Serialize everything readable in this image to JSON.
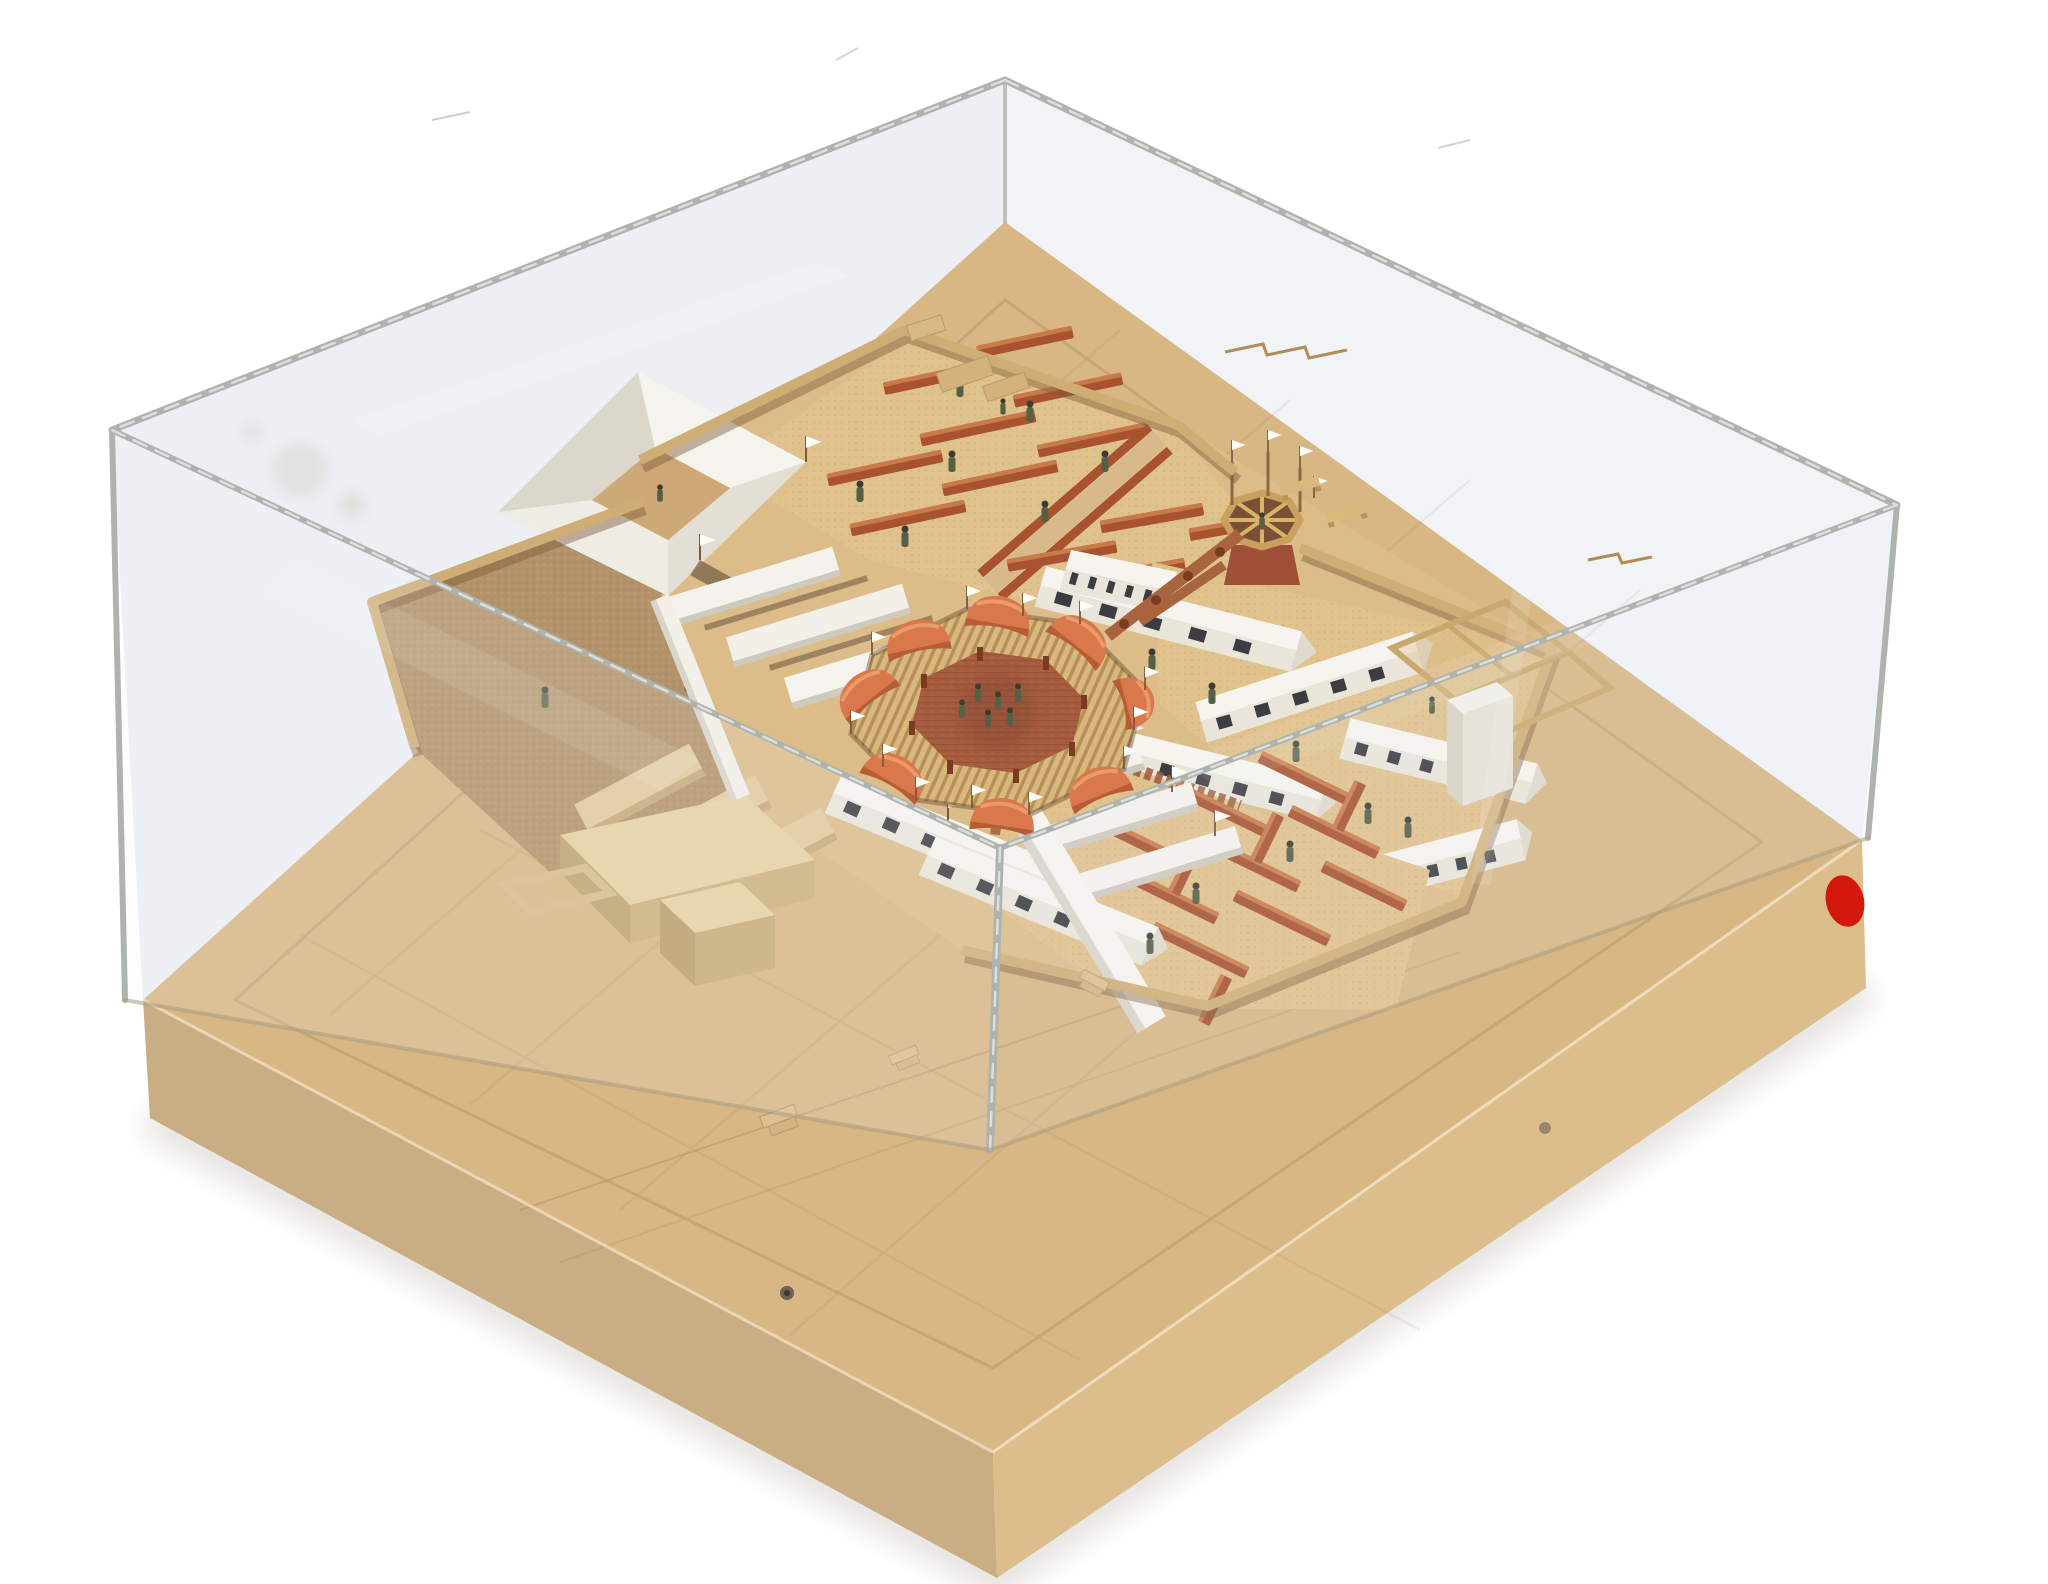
{
  "scene": {
    "type": "photograph",
    "subject": "architectural scale model of an octagonal walled prison-camp complex with radial courtyards, under a clear acrylic display case on a pale wooden base, three-quarter aerial view on white background"
  },
  "palette": {
    "background": "#ffffff",
    "acrylic_edge": "#aeb3af",
    "acrylic_tint": "#e9edf3",
    "wood_top": "#ddbd8a",
    "wood_side_left": "#c9ad83",
    "wood_side_right": "#dcbe8c",
    "terrain": "#dcbd8a",
    "sand": "#b2936a",
    "courtyard_floor": "#e0c28d",
    "brick_plaza": "#a65c3f",
    "pavilion_orange": "#d9784b",
    "pergola_wood": "#d8b87c",
    "roof_white": "#f6f4ee",
    "roof_shade": "#e0dcd0",
    "bench_red": "#a85230",
    "bench_highlight": "#c97a4a",
    "wall_wood": "#cfae76",
    "wall_shadow": "#7d5b3a",
    "basswood": "#e2cb9e",
    "figure_green": "#566044",
    "flag_white": "#fbfbf7",
    "red_sticker": "#d2190b",
    "tower_wood": "#d8b468",
    "tower_base": "#9e4f35",
    "window_dark": "#3c3c42"
  },
  "display_case": {
    "material": "clear acrylic",
    "faces_visible": 5,
    "edges_scuffed": true
  },
  "wooden_base": {
    "material": "light wood slab",
    "red_sticker_count": 1,
    "screw_count": 2,
    "stair_block_count": 3,
    "routed_outline": true
  },
  "model": {
    "center_plaza": {
      "shape": "octagon",
      "floor": "red brick",
      "figure_count": 6,
      "pavilion_count": 8,
      "flag_count": 12,
      "pergola_ring": true
    },
    "north_courtyard": {
      "bench_count": 12,
      "aisle": "diagonal central aisle",
      "figure_count": 8
    },
    "northwest_building": {
      "type": "courtyard ring of folded white roofs",
      "lean_to_roof_count": 3,
      "flag_count": 2
    },
    "watchtower": {
      "type": "octagonal timber frame under construction",
      "flag_count": 4,
      "figure_count": 1
    },
    "east_barracks": {
      "building_count": 6,
      "window_openings": true,
      "figure_count": 4
    },
    "south_courtyard": {
      "bench_count": 9,
      "bench_cross_stubs": 4,
      "canopy_count": 3,
      "gable_hut_count": 2,
      "flag_count": 4,
      "figure_count": 4
    },
    "southwest_yard": {
      "ground": "dark sand",
      "basswood_bar_count": 3,
      "service_building_blocks": 3,
      "figure_count": 2
    },
    "perimeter": {
      "walled": true,
      "corner_compartments": true,
      "white_tower_block": true,
      "terrace_sled_count": 2
    }
  }
}
